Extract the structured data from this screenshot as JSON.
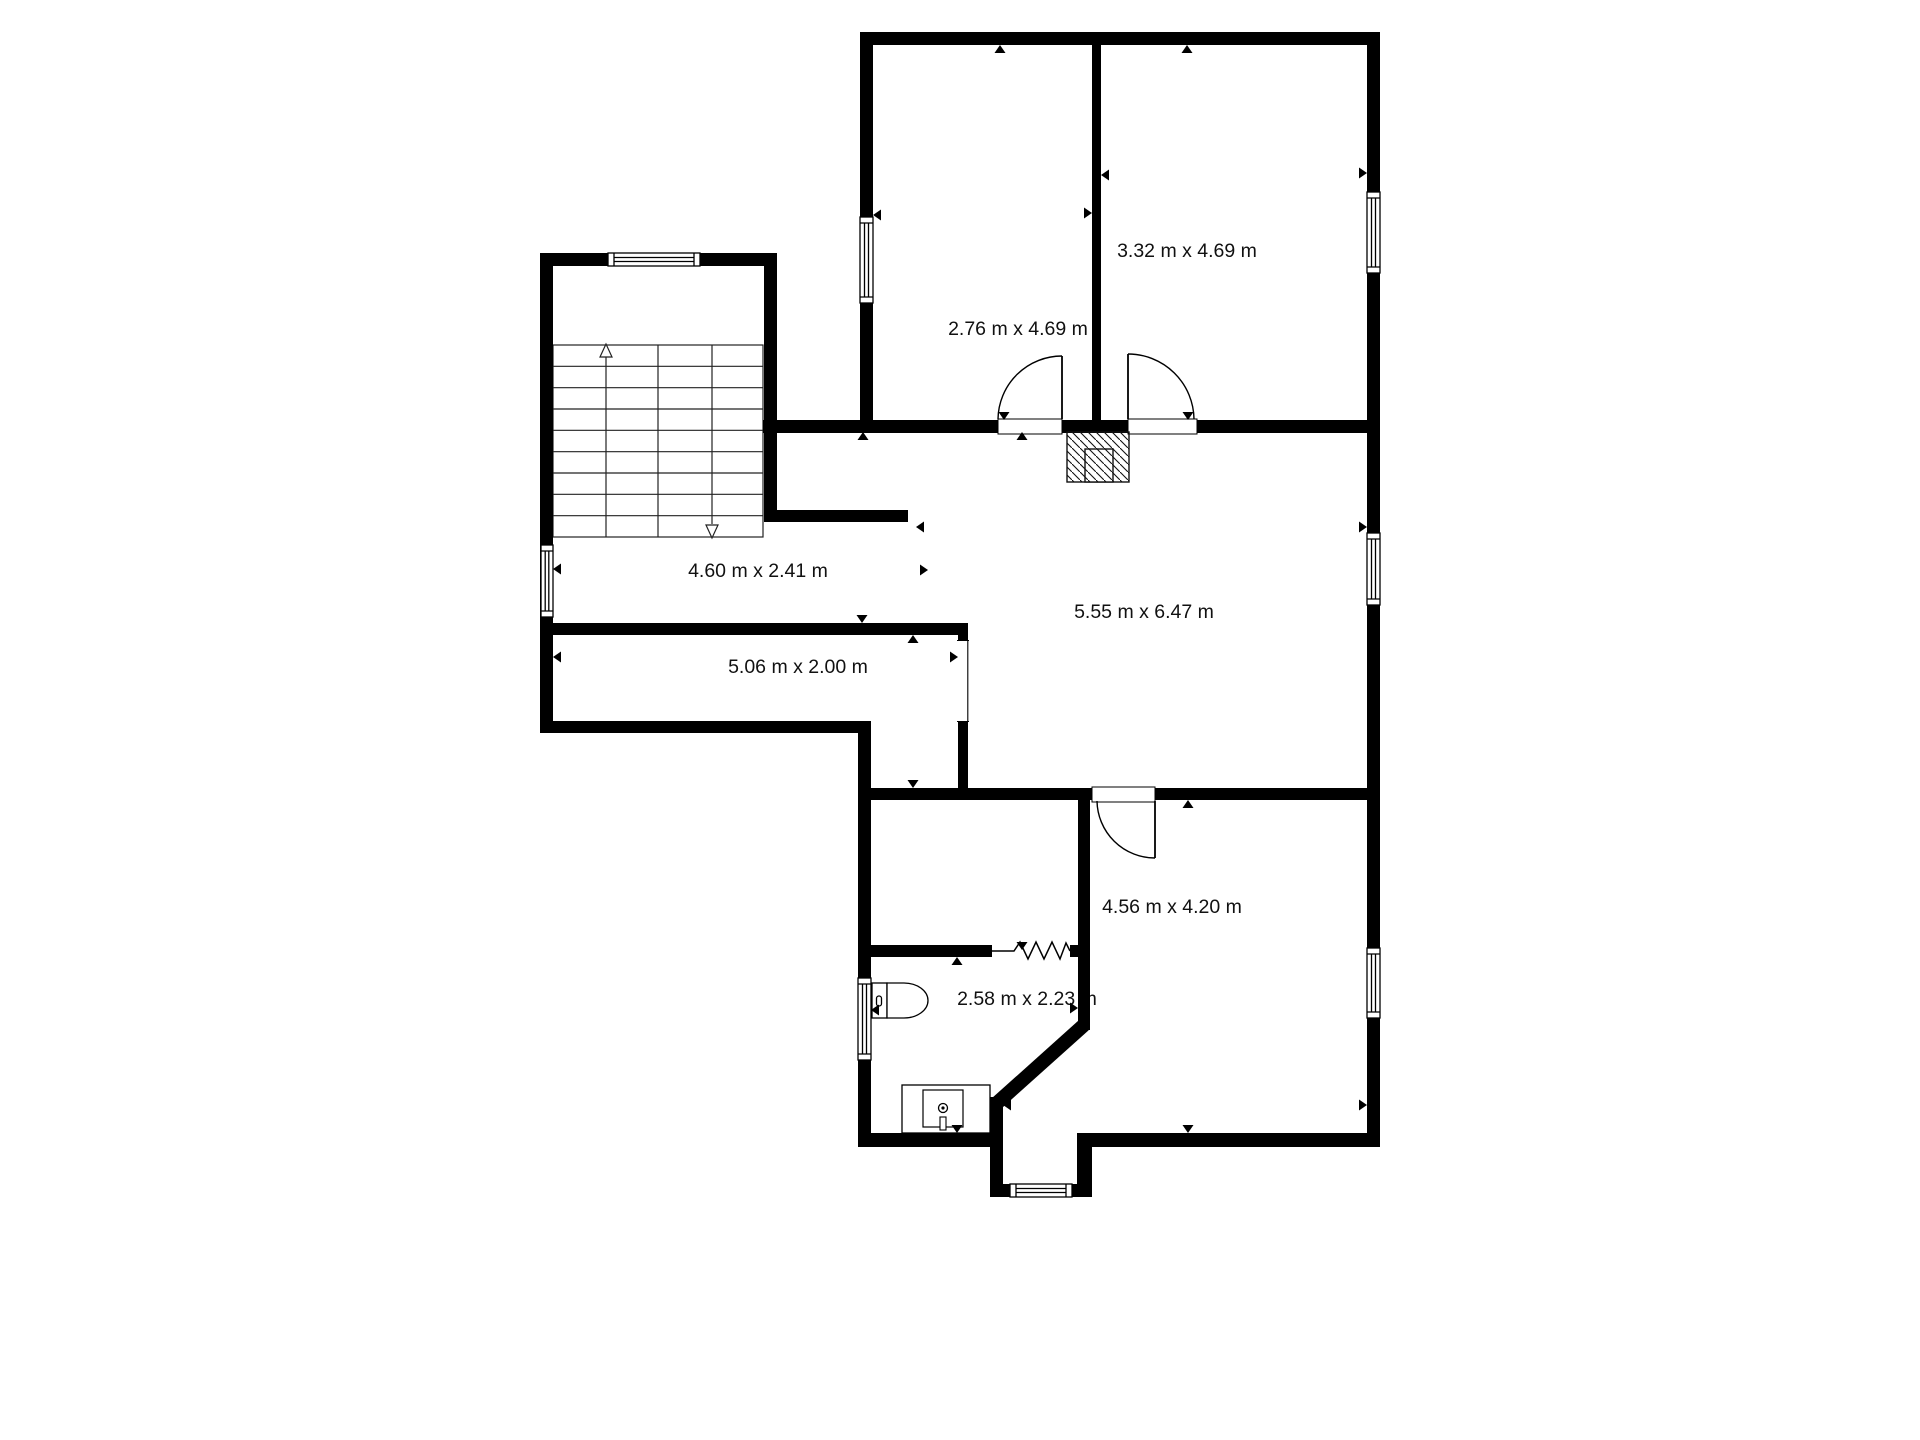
{
  "plan": {
    "background": "#ffffff",
    "wall_color": "#000000",
    "text_color": "#111111",
    "rooms": [
      {
        "id": "bedroom-top-left",
        "label": "2.76 m x 4.69 m"
      },
      {
        "id": "bedroom-top-right",
        "label": "3.32 m x 4.69 m"
      },
      {
        "id": "stair-hall",
        "label": "4.60 m x 2.41 m"
      },
      {
        "id": "living-room",
        "label": "5.55 m x 6.47 m"
      },
      {
        "id": "corridor",
        "label": "5.06 m x 2.00 m"
      },
      {
        "id": "bathroom",
        "label": "2.58 m x 2.23 m"
      },
      {
        "id": "bedroom-bottom",
        "label": "4.56 m x 4.20 m"
      }
    ],
    "fixtures": [
      {
        "id": "staircase",
        "name": "staircase-with-direction-arrows"
      },
      {
        "id": "chimney",
        "name": "chimney-hatched-square"
      },
      {
        "id": "toilet",
        "name": "toilet-icon"
      },
      {
        "id": "sink",
        "name": "sink-vanity-icon"
      }
    ]
  }
}
